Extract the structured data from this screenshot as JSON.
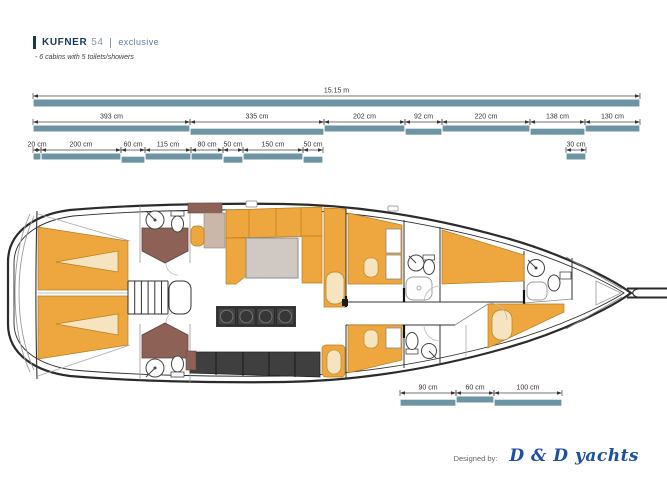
{
  "header": {
    "brand": "KUFNER",
    "model": "54",
    "edition": "exclusive",
    "subtitle": "- 6 cabins with 5 toilets/showers"
  },
  "footer": {
    "designed_by_label": "Designed by:",
    "designer": "D & D yachts"
  },
  "colors": {
    "teal_bar": "#6d94a2",
    "furniture_orange": "#eda73e",
    "cushion_cream": "#f6e3bf",
    "vanity_brown": "#8d6156",
    "cabinet_wood": "#cbb7aa",
    "table_gray": "#d0c8c2",
    "galley_dark": "#3a3a3a",
    "navy": "#16385c",
    "script_blue": "#1d4fa2"
  },
  "dimensions": {
    "rows": [
      {
        "y": 96,
        "bar_h": 7,
        "segments": [
          {
            "label": "15.15 m",
            "x1": 33,
            "x2": 640,
            "offset": 0
          }
        ]
      },
      {
        "y": 122,
        "bar_h": 6,
        "segments": [
          {
            "label": "393 cm",
            "x1": 33,
            "x2": 190,
            "offset": 0
          },
          {
            "label": "335 cm",
            "x1": 190,
            "x2": 324,
            "offset": 1
          },
          {
            "label": "202 cm",
            "x1": 324,
            "x2": 405,
            "offset": 0
          },
          {
            "label": "92 cm",
            "x1": 405,
            "x2": 442,
            "offset": 1
          },
          {
            "label": "220 cm",
            "x1": 442,
            "x2": 530,
            "offset": 0
          },
          {
            "label": "138 cm",
            "x1": 530,
            "x2": 585,
            "offset": 1
          },
          {
            "label": "130 cm",
            "x1": 585,
            "x2": 640,
            "offset": 0
          }
        ]
      },
      {
        "y": 150,
        "bar_h": 6,
        "segments": [
          {
            "label": "20 cm",
            "x1": 33,
            "x2": 41,
            "offset": 0
          },
          {
            "label": "200 cm",
            "x1": 41,
            "x2": 121,
            "offset": 0
          },
          {
            "label": "60 cm",
            "x1": 121,
            "x2": 145,
            "offset": 1
          },
          {
            "label": "115 cm",
            "x1": 145,
            "x2": 191,
            "offset": 0
          },
          {
            "label": "80 cm",
            "x1": 191,
            "x2": 223,
            "offset": 0
          },
          {
            "label": "50 cm",
            "x1": 223,
            "x2": 243,
            "offset": 1
          },
          {
            "label": "150 cm",
            "x1": 243,
            "x2": 303,
            "offset": 0
          },
          {
            "label": "50 cm",
            "x1": 303,
            "x2": 323,
            "offset": 1
          },
          {
            "label": "30 cm",
            "x1": 566,
            "x2": 586,
            "offset": 0
          }
        ]
      },
      {
        "y": 393,
        "bar_h": 6,
        "segments": [
          {
            "label": "90 cm",
            "x1": 400,
            "x2": 456,
            "offset": 1
          },
          {
            "label": "60 cm",
            "x1": 456,
            "x2": 494,
            "offset": 0
          },
          {
            "label": "100 cm",
            "x1": 494,
            "x2": 562,
            "offset": 1
          }
        ]
      }
    ]
  }
}
